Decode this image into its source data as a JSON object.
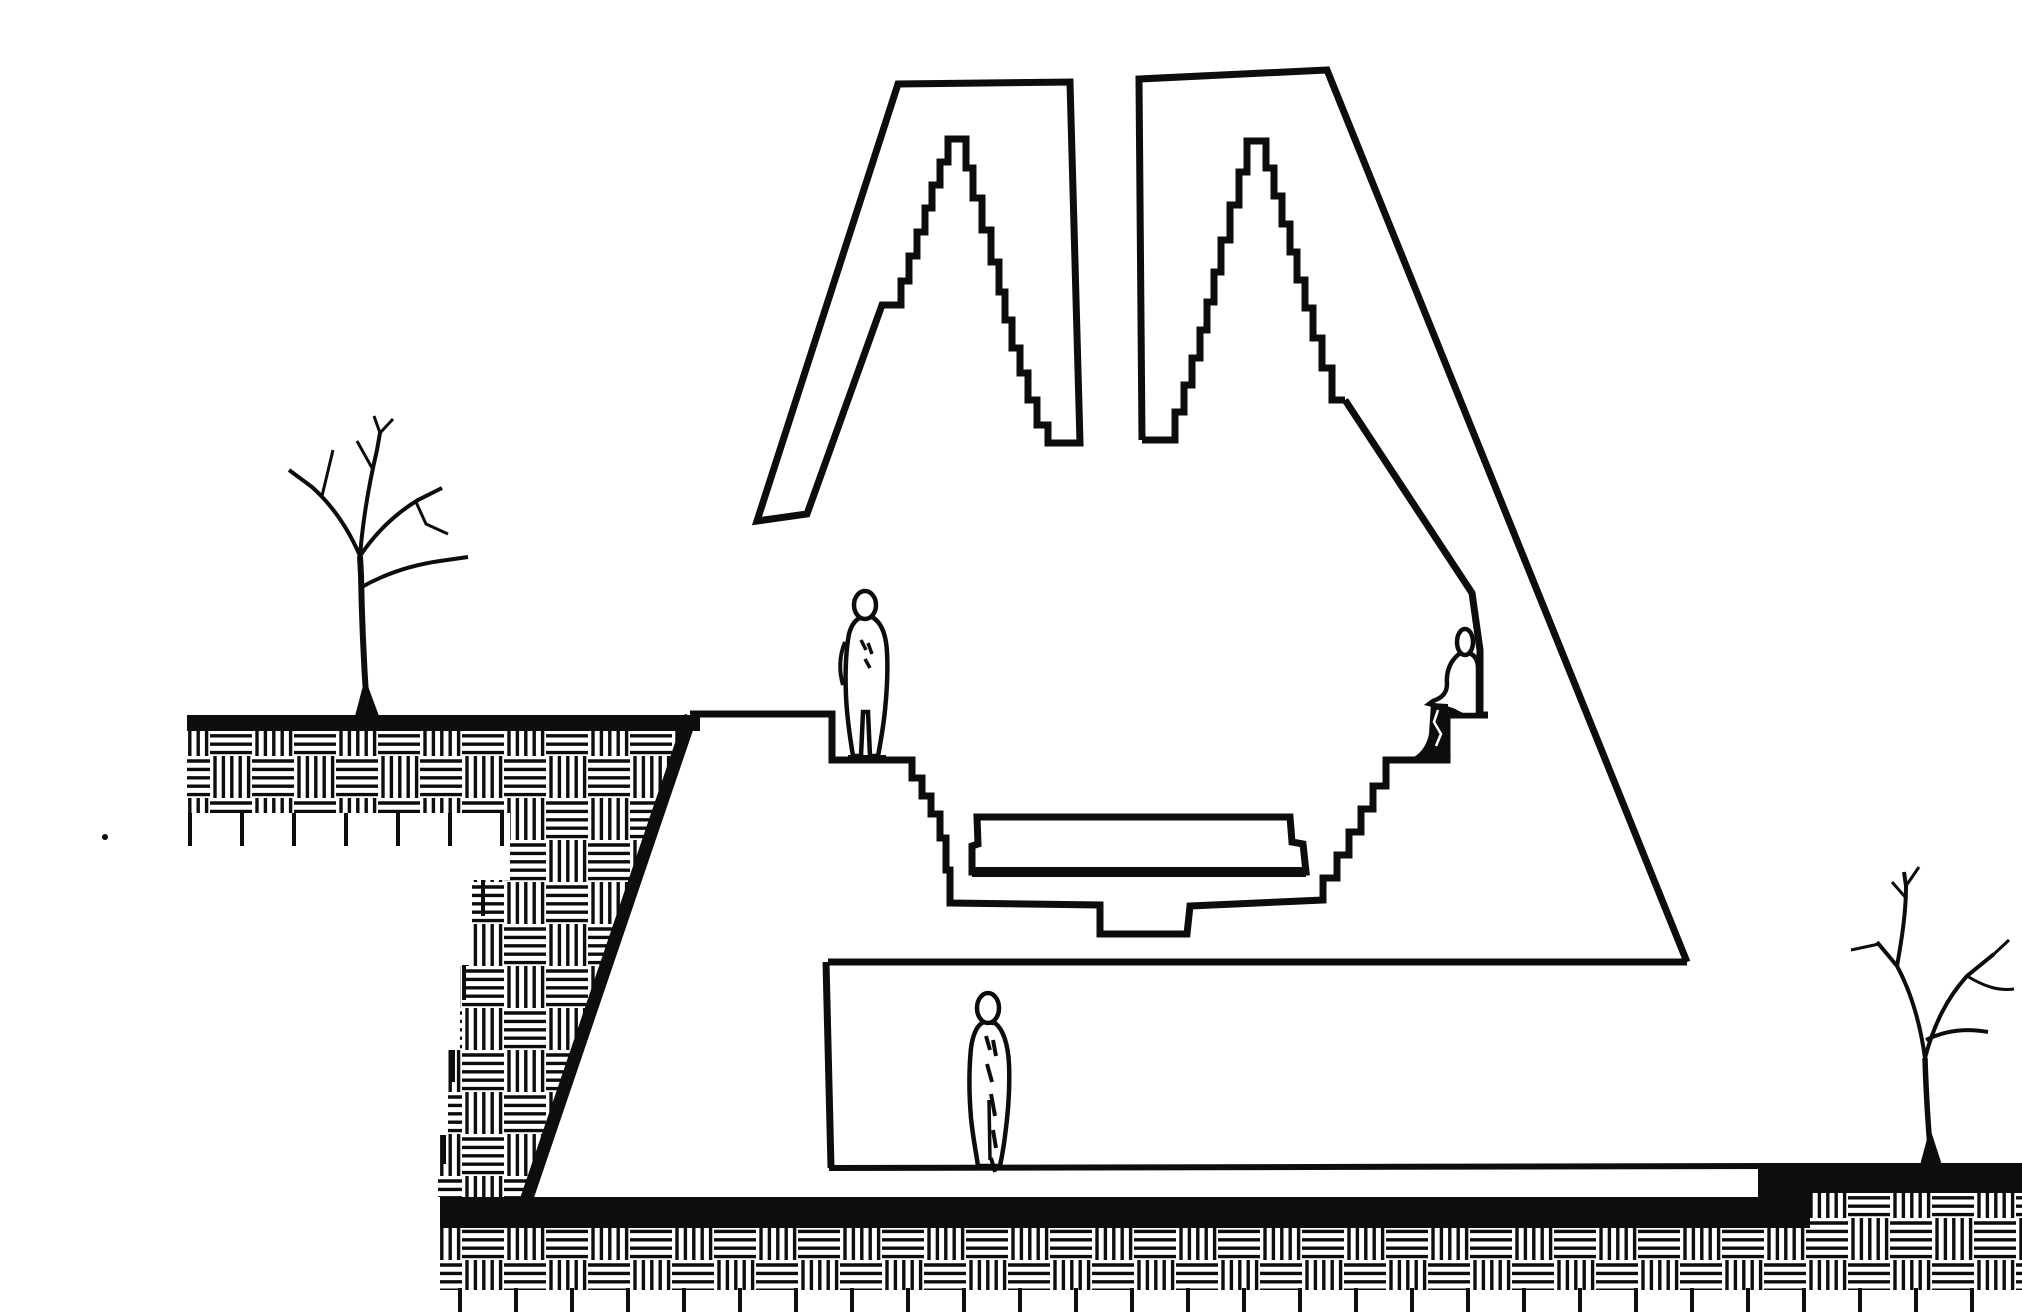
{
  "meta": {
    "title": "Hand-drawn architectural section: sunken stepped plaza with twin stepped-pyramid light towers, underground hall, three human figures and two bare trees",
    "canvas_width": 2022,
    "canvas_height": 1315,
    "background": "#ffffff",
    "ink": "#0d0d0d",
    "paper": "#ffffff",
    "elements": [
      "left-ground-with-tree",
      "earth-hatching",
      "retaining-wall",
      "left-stepped-tower",
      "right-stepped-tower",
      "sunken-amphitheatre",
      "bench-slab",
      "seated-figure",
      "standing-figure",
      "lower-hall",
      "lower-hall-figure",
      "foundation-slab",
      "right-ground-with-tree"
    ]
  },
  "drawing": {
    "hatch": {
      "cell": 42,
      "line_gap": 8.4,
      "stroke": 3.4,
      "inset": 5
    },
    "shapes": [
      {
        "name": "earth-hatch-left",
        "layer": "earth",
        "type": "polygon",
        "points": [
          [
            187,
            731
          ],
          [
            688,
            731
          ],
          [
            527,
            1197
          ],
          [
            438,
            1197
          ],
          [
            438,
            1135
          ],
          [
            448,
            1135
          ],
          [
            448,
            1050
          ],
          [
            460,
            1050
          ],
          [
            460,
            965
          ],
          [
            472,
            965
          ],
          [
            472,
            880
          ],
          [
            510,
            880
          ],
          [
            510,
            813
          ],
          [
            187,
            813
          ]
        ],
        "fill": "pattern"
      },
      {
        "name": "earth-hatch-bottom",
        "layer": "earth",
        "type": "polygon",
        "points": [
          [
            440,
            1228
          ],
          [
            2022,
            1228
          ],
          [
            2022,
            1290
          ],
          [
            440,
            1290
          ]
        ],
        "fill": "pattern"
      },
      {
        "name": "earth-hatch-right",
        "layer": "earth",
        "type": "polygon",
        "points": [
          [
            1762,
            1192
          ],
          [
            2022,
            1192
          ],
          [
            2022,
            1228
          ],
          [
            1762,
            1228
          ]
        ],
        "fill": "pattern"
      },
      {
        "name": "soil-ticks-upper",
        "layer": "earth",
        "type": "ticks",
        "x0": 190,
        "x1": 506,
        "step": 52,
        "y0": 813,
        "y1": 846,
        "w": 4
      },
      {
        "name": "soil-ticks-bottom",
        "layer": "earth",
        "type": "ticks",
        "x0": 460,
        "x1": 2016,
        "step": 56,
        "y0": 1288,
        "y1": 1312,
        "w": 4
      },
      {
        "name": "soil-tick-a",
        "layer": "earth",
        "type": "line",
        "x1": 483,
        "y1": 880,
        "x2": 483,
        "y2": 916,
        "w": 4
      },
      {
        "name": "soil-tick-b",
        "layer": "earth",
        "type": "line",
        "x1": 464,
        "y1": 965,
        "x2": 464,
        "y2": 1000,
        "w": 4
      },
      {
        "name": "soil-tick-c",
        "layer": "earth",
        "type": "line",
        "x1": 453,
        "y1": 1050,
        "x2": 453,
        "y2": 1082,
        "w": 4
      },
      {
        "name": "soil-tick-d",
        "layer": "earth",
        "type": "line",
        "x1": 444,
        "y1": 1135,
        "x2": 444,
        "y2": 1164,
        "w": 4
      },
      {
        "name": "ground-surface-left",
        "layer": "earth",
        "type": "line",
        "x1": 187,
        "y1": 723,
        "x2": 700,
        "y2": 723,
        "w": 16
      },
      {
        "name": "retaining-wall-diagonal",
        "layer": "earth",
        "type": "line",
        "x1": 691,
        "y1": 716,
        "x2": 527,
        "y2": 1198,
        "w": 13
      },
      {
        "name": "foundation-slab",
        "layer": "earth",
        "type": "rect",
        "x": 440,
        "y": 1197,
        "width": 1370,
        "height": 31,
        "fill": "ink"
      },
      {
        "name": "ground-step-block",
        "layer": "earth",
        "type": "rect",
        "x": 1758,
        "y": 1163,
        "width": 52,
        "height": 65,
        "fill": "ink"
      },
      {
        "name": "ground-surface-right",
        "layer": "earth",
        "type": "rect",
        "x": 1758,
        "y": 1163,
        "width": 264,
        "height": 30,
        "fill": "ink"
      },
      {
        "name": "left-stepped-tower",
        "layer": "structure",
        "type": "path",
        "w": 7,
        "d": "M 757,521 L 898,84 L 1070,82 L 1080,443 L 1048,443 L 1048,425 L 1037,425 L 1037,400 L 1028,400 L 1028,373 L 1020,373 L 1020,348 L 1012,348 L 1012,320 L 1005,320 L 1005,292 L 999,292 L 999,262 L 991,262 L 991,230 L 982,230 L 982,198 L 973,198 L 973,168 L 966,168 L 966,139 L 948,139 L 948,162 L 940,162 L 940,185 L 932,185 L 932,208 L 925,208 L 925,232 L 917,232 L 917,256 L 909,256 L 909,281 L 901,281 L 901,305 L 882,305 L 807,514 Z"
      },
      {
        "name": "right-tower-outer-wall",
        "layer": "structure",
        "type": "path",
        "w": 7,
        "d": "M 1142,440 L 1139,79 L 1327,70 L 1687,962"
      },
      {
        "name": "right-tower-stepped-void",
        "layer": "structure",
        "type": "path",
        "w": 7,
        "d": "M 1142,440 L 1175,440 L 1175,412 L 1184,412 L 1184,385 L 1192,385 L 1192,358 L 1200,358 L 1200,330 L 1207,330 L 1207,302 L 1214,302 L 1214,272 L 1221,272 L 1221,240 L 1230,240 L 1230,205 L 1239,205 L 1239,172 L 1247,172 L 1247,141 L 1266,141 L 1266,168 L 1274,168 L 1274,196 L 1282,196 L 1282,224 L 1290,224 L 1290,252 L 1297,252 L 1297,280 L 1305,280 L 1305,308 L 1313,308 L 1313,338 L 1322,338 L 1322,368 L 1332,368 L 1332,400 L 1345,400"
      },
      {
        "name": "amphitheatre-step-profile",
        "layer": "structure",
        "type": "path",
        "w": 7,
        "d": "M 690,714 L 832,714 L 832,760 L 912,760 L 912,778 L 922,778 L 922,796 L 931,796 L 931,814 L 940,814 L 940,838 L 946,838 L 946,870 L 950,870 L 950,903 L 1100,905 L 1100,934 L 1187,934 L 1190,906 L 1323,900 L 1323,878 L 1337,878 L 1337,855 L 1349,855 L 1349,832 L 1361,832 L 1361,809 L 1373,809 L 1373,786 L 1386,786 L 1386,760 L 1447,760 L 1447,715 L 1488,715"
      },
      {
        "name": "seat-back-wall",
        "layer": "structure",
        "type": "path",
        "w": 7,
        "d": "M 1480,715 L 1480,650 L 1472,593 L 1345,400"
      },
      {
        "name": "lower-hall-roof",
        "layer": "structure",
        "type": "line",
        "x1": 828,
        "y1": 962,
        "x2": 1687,
        "y2": 962,
        "w": 7
      },
      {
        "name": "lower-hall-left-wall",
        "layer": "structure",
        "type": "line",
        "x1": 826,
        "y1": 962,
        "x2": 831,
        "y2": 1168,
        "w": 7
      },
      {
        "name": "lower-hall-floor",
        "layer": "structure",
        "type": "line",
        "x1": 829,
        "y1": 1168,
        "x2": 1773,
        "y2": 1166,
        "w": 6
      },
      {
        "name": "bench-slab",
        "layer": "furniture",
        "type": "path",
        "w": 7,
        "fill": "white",
        "d": "M 977,817 L 1290,817 L 1292,842 L 1303,844 L 1306,872 L 972,872 L 972,846 L 978,844 Z"
      },
      {
        "name": "bench-base-line",
        "layer": "furniture",
        "type": "line",
        "x1": 972,
        "y1": 872,
        "x2": 1306,
        "y2": 872,
        "w": 10
      },
      {
        "name": "tree-left-root-flare",
        "layer": "vegetation",
        "type": "path",
        "d": "M 355,716 L 365,678 L 379,716 Z",
        "fill": "ink"
      },
      {
        "name": "tree-left-trunk",
        "layer": "vegetation",
        "type": "path",
        "w": 6,
        "d": "M 367,710 C 364,668 362,628 361,575 L 360,556"
      },
      {
        "name": "tree-left-branches",
        "layer": "vegetation",
        "type": "path",
        "w": 4,
        "d": "M 360,556 C 348,528 332,505 312,487 L 289,470 M 360,556 C 363,518 369,484 377,450 L 380,433 M 360,556 C 376,532 395,514 418,500 L 442,488 M 360,588 C 386,573 412,565 440,561 L 468,557"
      },
      {
        "name": "tree-left-twigs",
        "layer": "vegetation",
        "type": "path",
        "w": 3,
        "d": "M 322,496 L 333,450 M 372,468 L 357,441 M 380,433 L 374,416 M 380,433 L 393,419 M 416,502 L 426,524 L 448,534"
      },
      {
        "name": "tree-right-root-flare",
        "layer": "vegetation",
        "type": "path",
        "d": "M 1920,1165 L 1930,1128 L 1942,1165 Z",
        "fill": "ink"
      },
      {
        "name": "tree-right-trunk",
        "layer": "vegetation",
        "type": "path",
        "w": 5.5,
        "d": "M 1931,1160 C 1928,1124 1926,1094 1925,1058"
      },
      {
        "name": "tree-right-branches",
        "layer": "vegetation",
        "type": "path",
        "w": 4,
        "d": "M 1925,1058 C 1920,1022 1911,992 1897,966 L 1877,942 M 1897,966 C 1902,938 1906,912 1906,886 L 1904,872 M 1925,1058 C 1934,1024 1947,998 1967,976 L 1994,954 M 1926,1040 C 1946,1030 1966,1028 1988,1032"
      },
      {
        "name": "tree-right-twigs",
        "layer": "vegetation",
        "type": "path",
        "w": 3,
        "d": "M 1879,944 L 1851,950 M 1906,898 L 1892,882 M 1906,886 L 1919,867 M 1967,976 C 1985,987 1999,991 2014,989 M 1994,954 L 2009,940"
      },
      {
        "name": "standing-figure-body",
        "layer": "people",
        "type": "path",
        "w": 4.5,
        "fill": "white",
        "d": "M 872,617 C 881,622 886,634 887,652 C 888,670 887,690 885,710 C 883,730 880,745 878,756 L 870,756 L 868,712 L 863,712 L 861,756 L 853,756 C 850,738 847,718 846,696 C 845,672 846,650 849,634 C 852,623 857,618 863,617 Z"
      },
      {
        "name": "standing-figure-head",
        "layer": "people",
        "type": "ellipse",
        "cx": 865,
        "cy": 605,
        "rx": 11,
        "ry": 14,
        "w": 4.5,
        "fill": "white"
      },
      {
        "name": "standing-figure-arm",
        "layer": "people",
        "type": "path",
        "w": 4,
        "d": "M 845,642 C 839,656 839,672 843,685"
      },
      {
        "name": "standing-figure-shading",
        "layer": "people",
        "type": "path",
        "w": 3.5,
        "d": "M 861,640 l 5,10 m 2,-7 l 4,11 m -7,5 l 5,9"
      },
      {
        "name": "standing-figure-feet",
        "layer": "people",
        "type": "line",
        "x1": 848,
        "y1": 757,
        "x2": 886,
        "y2": 757,
        "w": 4
      },
      {
        "name": "seated-figure-body",
        "layer": "people",
        "type": "path",
        "w": 4.5,
        "fill": "white",
        "d": "M 1459,654 C 1450,661 1446,672 1447,684 C 1447,693 1442,698 1433,701 L 1429,704 C 1437,706 1449,708 1456,712 L 1462,715 L 1478,715 L 1478,668 C 1478,657 1472,653 1465,652 Z"
      },
      {
        "name": "seated-figure-head",
        "layer": "people",
        "type": "ellipse",
        "cx": 1465,
        "cy": 642,
        "rx": 8,
        "ry": 13,
        "w": 4.5,
        "fill": "white"
      },
      {
        "name": "seated-figure-legs",
        "layer": "people",
        "type": "path",
        "fill": "ink",
        "d": "M 1431,703 L 1448,704 L 1447,750 L 1451,757 L 1414,757 C 1422,752 1427,744 1429,734 Z"
      },
      {
        "name": "seated-figure-leg-highlight",
        "layer": "people",
        "type": "path",
        "w": 2.5,
        "stroke": "white",
        "d": "M 1438,710 L 1434,722 L 1441,734 L 1436,746"
      },
      {
        "name": "lower-figure-body",
        "layer": "people",
        "type": "path",
        "w": 4.5,
        "fill": "white",
        "d": "M 995,1023 C 1003,1029 1008,1044 1009,1064 C 1010,1088 1008,1114 1005,1136 C 1003,1152 1001,1161 1000,1166 L 978,1166 C 976,1152 973,1138 971,1118 C 969,1094 969,1068 971,1048 C 973,1033 978,1024 984,1022 Z"
      },
      {
        "name": "lower-figure-head",
        "layer": "people",
        "type": "ellipse",
        "cx": 988,
        "cy": 1008,
        "rx": 11,
        "ry": 15,
        "w": 4.5,
        "fill": "white"
      },
      {
        "name": "lower-figure-shading",
        "layer": "people",
        "type": "path",
        "w": 4,
        "d": "M 986,1036 l 4,14 m 3,-10 l 3,16 m -9,8 l 5,18 m -1,12 l 4,22 m -2,14 l 3,18 m -5,10 l 4,14"
      },
      {
        "name": "lower-figure-leg-line",
        "layer": "people",
        "type": "line",
        "x1": 989,
        "y1": 1100,
        "x2": 990,
        "y2": 1160,
        "w": 3.5
      },
      {
        "name": "stray-ink-dot",
        "layer": "marks",
        "type": "ellipse",
        "cx": 105,
        "cy": 837,
        "rx": 3,
        "ry": 3,
        "fill": "ink"
      }
    ]
  }
}
